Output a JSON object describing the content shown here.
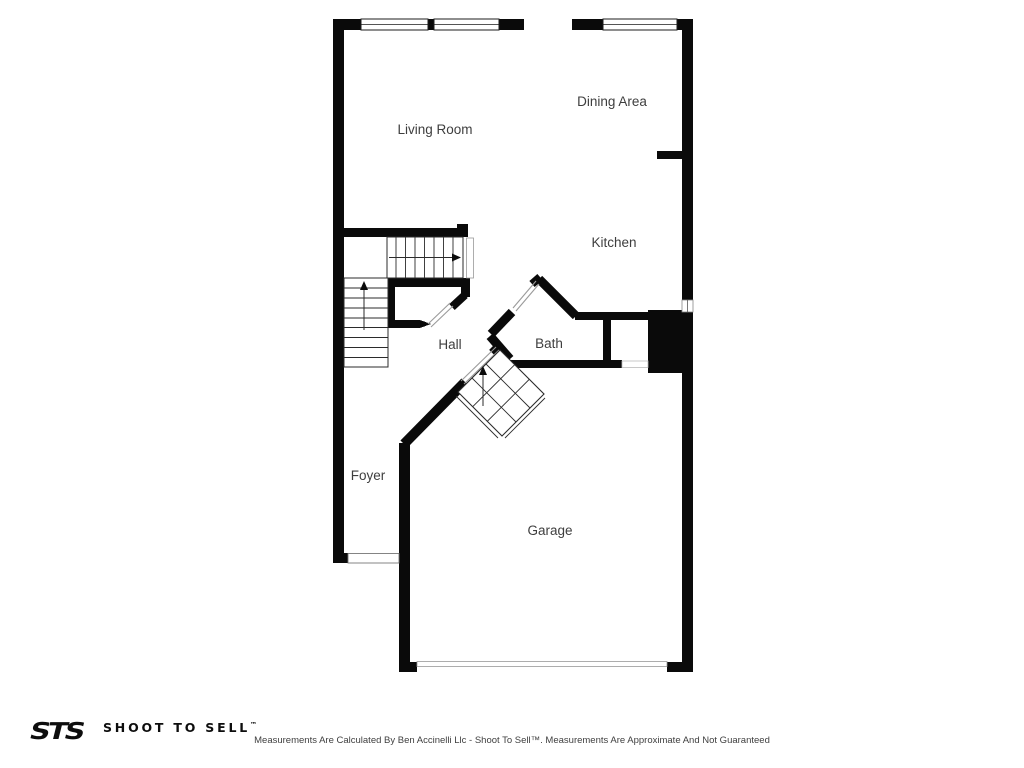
{
  "plan": {
    "rooms": [
      {
        "label": "Living Room"
      },
      {
        "label": "Dining Area"
      },
      {
        "label": "Kitchen"
      },
      {
        "label": "Hall"
      },
      {
        "label": "Bath"
      },
      {
        "label": "Foyer"
      },
      {
        "label": "Garage"
      }
    ]
  },
  "footer": {
    "logo": "STS",
    "brand": "SHOOT TO SELL",
    "brand_tm": "™",
    "disclaimer": "Measurements Are Calculated By Ben Accinelli Llc - Shoot To Sell™. Measurements Are Approximate And Not Guaranteed"
  },
  "colors": {
    "wall": "#0a0a0a",
    "label_text": "#3e3e3e",
    "background": "#ffffff"
  }
}
